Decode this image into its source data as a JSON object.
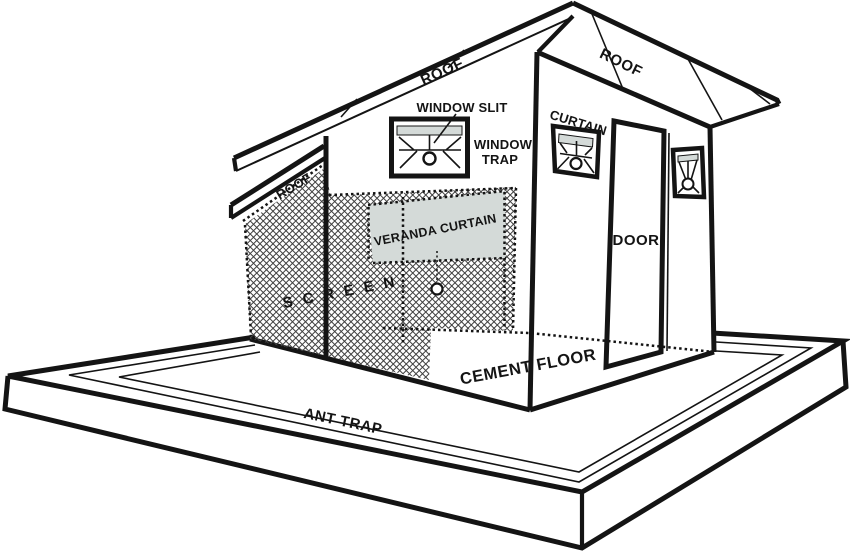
{
  "diagram": {
    "description_labels": {
      "roof_main_left": "ROOF",
      "roof_main_right": "ROOF",
      "roof_veranda": "ROOF",
      "window_slit": "WINDOW SLIT",
      "window_trap_line1": "WINDOW",
      "window_trap_line2": "TRAP",
      "curtain": "CURTAIN",
      "veranda_curtain": "VERANDA CURTAIN",
      "screen": "S C R E E N",
      "door": "DOOR",
      "cement_floor": "CEMENT FLOOR",
      "ant_trap": "ANT TRAP"
    },
    "colors": {
      "background": "#ffffff",
      "ink": "#141414",
      "curtain_gray": "#d4dad8",
      "mesh_line": "#404040"
    }
  }
}
